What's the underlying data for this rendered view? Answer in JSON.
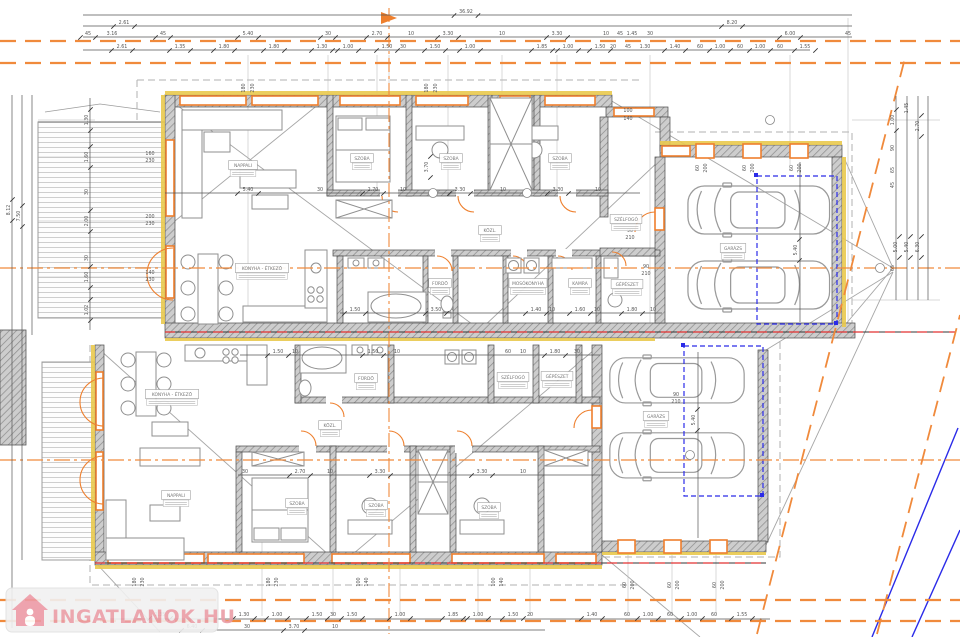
{
  "watermark": {
    "text": "INGATLANOK.HU"
  },
  "colors": {
    "property_orange": "#F08A3C",
    "window_orange": "#EE7F2D",
    "wall_gray": "#c9c9c9",
    "red_axis": "#E23030",
    "blue_line": "#2B2BE8",
    "insulation_yellow": "#E9C94E",
    "watermark_pink": "#EB9DA6",
    "dim_text": "#555555"
  },
  "rooms": [
    [
      "NAPPALI",
      243,
      167
    ],
    [
      "SZOBA",
      362,
      160
    ],
    [
      "SZOBA",
      451,
      160
    ],
    [
      "SZOBA",
      560,
      160
    ],
    [
      "KÖZL.",
      490,
      232
    ],
    [
      "SZÉLFOGÓ",
      626,
      221
    ],
    [
      "FÜRDŐ",
      440,
      285
    ],
    [
      "MOSÓKONYHA",
      528,
      285
    ],
    [
      "KAMRA",
      580,
      285
    ],
    [
      "GÉPÉSZET",
      627,
      286
    ],
    [
      "KONYHA - ÉTKEZŐ",
      262,
      270
    ],
    [
      "GARÁZS",
      733,
      250
    ],
    [
      "KONYHA - ÉTKEZŐ",
      172,
      396
    ],
    [
      "FÜRDŐ",
      366,
      380
    ],
    [
      "SZÉLFOGÓ",
      513,
      379
    ],
    [
      "GÉPÉSZET",
      557,
      378
    ],
    [
      "KÖZL.",
      330,
      427
    ],
    [
      "NAPPALI",
      176,
      497
    ],
    [
      "SZOBA",
      297,
      505
    ],
    [
      "SZOBA",
      376,
      507
    ],
    [
      "SZOBA",
      489,
      509
    ],
    [
      "GARÁZS",
      656,
      418
    ]
  ],
  "annotations": [
    [
      "36.92",
      466,
      13,
      0,
      1
    ],
    [
      "2.61",
      124,
      24,
      0,
      1
    ],
    [
      "8.20",
      732,
      24,
      0,
      1
    ],
    [
      "45",
      88,
      35,
      0,
      1
    ],
    [
      "3.16",
      112,
      35,
      0,
      0
    ],
    [
      "45",
      163,
      35,
      0,
      1
    ],
    [
      "5.40",
      248,
      35,
      0,
      1
    ],
    [
      "30",
      328,
      35,
      0,
      1
    ],
    [
      "2.70",
      377,
      35,
      0,
      1
    ],
    [
      "10",
      411,
      35,
      0,
      0
    ],
    [
      "3.30",
      448,
      35,
      0,
      1
    ],
    [
      "10",
      502,
      35,
      0,
      0
    ],
    [
      "3.30",
      557,
      35,
      0,
      1
    ],
    [
      "10",
      606,
      35,
      0,
      0
    ],
    [
      "45",
      620,
      35,
      0,
      0
    ],
    [
      "1.45",
      632,
      35,
      0,
      0
    ],
    [
      "30",
      650,
      35,
      0,
      0
    ],
    [
      "6.00",
      790,
      35,
      0,
      1
    ],
    [
      "45",
      848,
      35,
      0,
      0
    ],
    [
      "2.61",
      122,
      48,
      0,
      1
    ],
    [
      "1.35",
      180,
      48,
      0,
      1
    ],
    [
      "1.80",
      224,
      48,
      0,
      1
    ],
    [
      "1.80",
      274,
      48,
      0,
      1
    ],
    [
      "1.30",
      322,
      48,
      0,
      1
    ],
    [
      "1.00",
      348,
      48,
      0,
      1
    ],
    [
      "1.50",
      387,
      48,
      0,
      1
    ],
    [
      "30",
      403,
      48,
      0,
      0
    ],
    [
      "1.50",
      435,
      48,
      0,
      1
    ],
    [
      "1.00",
      470,
      48,
      0,
      1
    ],
    [
      "1.85",
      542,
      48,
      0,
      1
    ],
    [
      "1.00",
      568,
      48,
      0,
      1
    ],
    [
      "1.50",
      600,
      48,
      0,
      1
    ],
    [
      "20",
      613,
      48,
      0,
      0
    ],
    [
      "45",
      628,
      48,
      0,
      0
    ],
    [
      "1.30",
      645,
      48,
      0,
      0
    ],
    [
      "1.40",
      675,
      48,
      0,
      1
    ],
    [
      "60",
      700,
      48,
      0,
      0
    ],
    [
      "1.00",
      720,
      48,
      0,
      1
    ],
    [
      "60",
      740,
      48,
      0,
      0
    ],
    [
      "1.00",
      760,
      48,
      0,
      1
    ],
    [
      "60",
      780,
      48,
      0,
      0
    ],
    [
      "1.55",
      805,
      48,
      0,
      1
    ],
    [
      "8.12",
      10,
      210,
      1,
      1
    ],
    [
      "7.50",
      20,
      216,
      1,
      1
    ],
    [
      "1.30",
      88,
      120,
      1,
      1
    ],
    [
      "1.60",
      88,
      157,
      1,
      1
    ],
    [
      "30",
      88,
      192,
      1,
      0
    ],
    [
      "2.00",
      88,
      221,
      1,
      1
    ],
    [
      "30",
      88,
      258,
      1,
      0
    ],
    [
      "1.60",
      88,
      277,
      1,
      1
    ],
    [
      "1.02",
      88,
      310,
      1,
      1
    ],
    [
      "160",
      150,
      155,
      0,
      0
    ],
    [
      "230",
      150,
      162,
      0,
      0
    ],
    [
      "200",
      150,
      218,
      0,
      0
    ],
    [
      "230",
      150,
      225,
      0,
      0
    ],
    [
      "140",
      150,
      274,
      0,
      0
    ],
    [
      "230",
      150,
      281,
      0,
      0
    ],
    [
      "1.45",
      908,
      108,
      1,
      0
    ],
    [
      "1.00",
      894,
      120,
      1,
      1
    ],
    [
      "2.70",
      919,
      126,
      1,
      1
    ],
    [
      "90",
      894,
      148,
      1,
      0
    ],
    [
      "65",
      894,
      170,
      1,
      0
    ],
    [
      "45",
      894,
      185,
      1,
      0
    ],
    [
      "5.00",
      897,
      247,
      1,
      1
    ],
    [
      "5.40",
      908,
      247,
      1,
      1
    ],
    [
      "6.30",
      919,
      247,
      1,
      1
    ],
    [
      "65",
      894,
      268,
      1,
      0
    ],
    [
      "1.35",
      160,
      616,
      0,
      1
    ],
    [
      "1.30",
      244,
      616,
      0,
      1
    ],
    [
      "1.00",
      277,
      616,
      0,
      1
    ],
    [
      "1.50",
      317,
      616,
      0,
      1
    ],
    [
      "30",
      333,
      616,
      0,
      0
    ],
    [
      "1.50",
      352,
      616,
      0,
      1
    ],
    [
      "1.00",
      400,
      616,
      0,
      1
    ],
    [
      "1.85",
      453,
      616,
      0,
      1
    ],
    [
      "1.00",
      478,
      616,
      0,
      1
    ],
    [
      "1.50",
      513,
      616,
      0,
      1
    ],
    [
      "20",
      530,
      616,
      0,
      0
    ],
    [
      "1.40",
      592,
      616,
      0,
      1
    ],
    [
      "60",
      627,
      616,
      0,
      0
    ],
    [
      "1.00",
      648,
      616,
      0,
      1
    ],
    [
      "60",
      670,
      616,
      0,
      0
    ],
    [
      "1.00",
      692,
      616,
      0,
      1
    ],
    [
      "60",
      714,
      616,
      0,
      0
    ],
    [
      "1.55",
      742,
      616,
      0,
      1
    ],
    [
      "6.40",
      192,
      628,
      0,
      1
    ],
    [
      "30",
      247,
      628,
      0,
      0
    ],
    [
      "3.70",
      294,
      628,
      0,
      1
    ],
    [
      "10",
      335,
      628,
      0,
      0
    ],
    [
      "5.40",
      248,
      191,
      0,
      1
    ],
    [
      "30",
      320,
      191,
      0,
      0
    ],
    [
      "2.70",
      373,
      191,
      0,
      1
    ],
    [
      "10",
      403,
      191,
      0,
      0
    ],
    [
      "3.30",
      460,
      191,
      0,
      1
    ],
    [
      "10",
      503,
      191,
      0,
      0
    ],
    [
      "3.30",
      558,
      191,
      0,
      1
    ],
    [
      "10",
      598,
      191,
      0,
      0
    ],
    [
      "1.50",
      355,
      311,
      0,
      1
    ],
    [
      "3.50",
      436,
      311,
      0,
      1
    ],
    [
      "1.40",
      536,
      311,
      0,
      1
    ],
    [
      "10",
      552,
      311,
      0,
      0
    ],
    [
      "1.60",
      580,
      311,
      0,
      1
    ],
    [
      "10",
      597,
      311,
      0,
      0
    ],
    [
      "1.80",
      632,
      311,
      0,
      1
    ],
    [
      "10",
      653,
      311,
      0,
      0
    ],
    [
      "1.50",
      278,
      353,
      0,
      1
    ],
    [
      "10",
      295,
      353,
      0,
      0
    ],
    [
      "1.50",
      373,
      353,
      0,
      1
    ],
    [
      "10",
      397,
      353,
      0,
      0
    ],
    [
      "60",
      508,
      353,
      0,
      0
    ],
    [
      "10",
      523,
      353,
      0,
      0
    ],
    [
      "1.80",
      555,
      353,
      0,
      1
    ],
    [
      "30",
      577,
      353,
      0,
      0
    ],
    [
      "30",
      245,
      473,
      0,
      0
    ],
    [
      "2.70",
      300,
      473,
      0,
      1
    ],
    [
      "10",
      330,
      473,
      0,
      0
    ],
    [
      "3.30",
      380,
      473,
      0,
      1
    ],
    [
      "3.30",
      482,
      473,
      0,
      1
    ],
    [
      "10",
      523,
      473,
      0,
      0
    ],
    [
      "5.40",
      797,
      250,
      1,
      1
    ],
    [
      "5.40",
      695,
      420,
      1,
      1
    ],
    [
      "3.70",
      428,
      167,
      1,
      1
    ],
    [
      "60",
      699,
      168,
      1,
      0
    ],
    [
      "200",
      707,
      168,
      1,
      0
    ],
    [
      "60",
      746,
      168,
      1,
      0
    ],
    [
      "200",
      754,
      168,
      1,
      0
    ],
    [
      "60",
      793,
      168,
      1,
      0
    ],
    [
      "200",
      801,
      168,
      1,
      0
    ],
    [
      "60",
      626,
      585,
      1,
      0
    ],
    [
      "200",
      634,
      585,
      1,
      0
    ],
    [
      "60",
      671,
      585,
      1,
      0
    ],
    [
      "200",
      679,
      585,
      1,
      0
    ],
    [
      "60",
      716,
      585,
      1,
      0
    ],
    [
      "200",
      724,
      585,
      1,
      0
    ],
    [
      "180",
      245,
      88,
      1,
      0
    ],
    [
      "230",
      254,
      88,
      1,
      0
    ],
    [
      "180",
      428,
      88,
      1,
      0
    ],
    [
      "230",
      437,
      88,
      1,
      0
    ],
    [
      "180",
      136,
      582,
      1,
      0
    ],
    [
      "230",
      144,
      582,
      1,
      0
    ],
    [
      "180",
      270,
      582,
      1,
      0
    ],
    [
      "230",
      278,
      582,
      1,
      0
    ],
    [
      "100",
      360,
      582,
      1,
      0
    ],
    [
      "140",
      368,
      582,
      1,
      0
    ],
    [
      "100",
      495,
      582,
      1,
      0
    ],
    [
      "140",
      503,
      582,
      1,
      0
    ],
    [
      "90",
      630,
      232,
      0,
      0
    ],
    [
      "210",
      630,
      239,
      0,
      0
    ],
    [
      "90",
      646,
      268,
      0,
      0
    ],
    [
      "210",
      646,
      275,
      0,
      0
    ],
    [
      "90",
      676,
      396,
      0,
      0
    ],
    [
      "210",
      676,
      403,
      0,
      0
    ],
    [
      "100",
      628,
      112,
      0,
      0
    ],
    [
      "140",
      628,
      120,
      0,
      0
    ]
  ]
}
